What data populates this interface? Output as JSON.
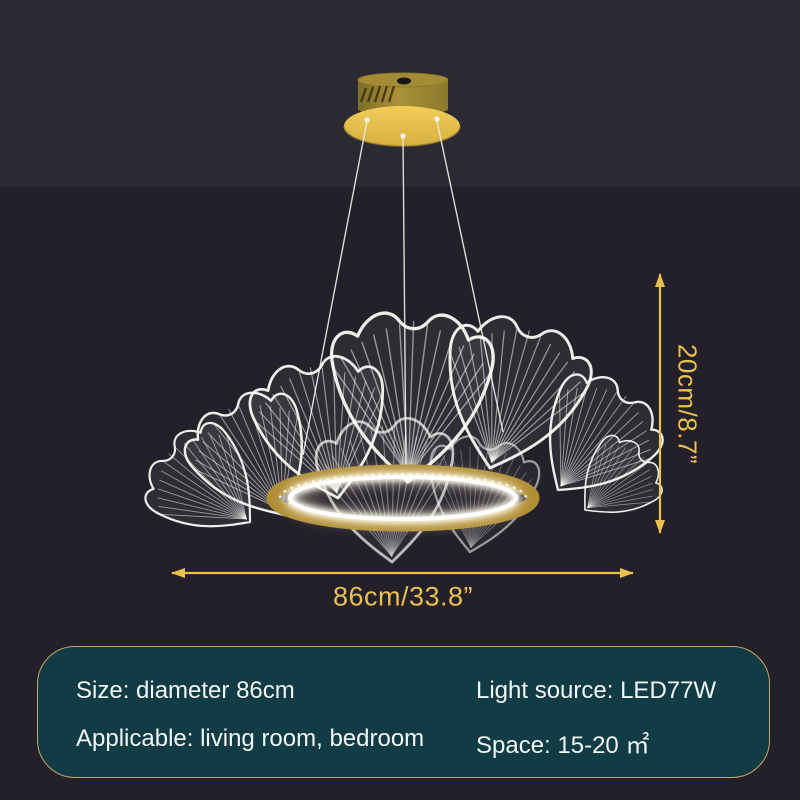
{
  "dimensions": {
    "height": "20cm/8.7”",
    "diameter": "86cm/33.8”"
  },
  "specs": {
    "size": "Size: diameter 86cm",
    "light_source": "Light source: LED77W",
    "applicable": "Applicable: living room, bedroom",
    "space": "Space: 15-20 ㎡"
  },
  "icons": {
    "height_arrow": "double-arrow-vertical",
    "diameter_arrow": "double-arrow-horizontal"
  },
  "colors": {
    "accent_gold": "#eac14e",
    "ring_gold": "#b08d35",
    "canopy_gold": "#e8c34e",
    "panel_teal": "#113c45",
    "panel_border": "#c8a469",
    "background_top": "#2b2932",
    "background_bottom": "#232029",
    "led_white": "#fffdf2"
  }
}
